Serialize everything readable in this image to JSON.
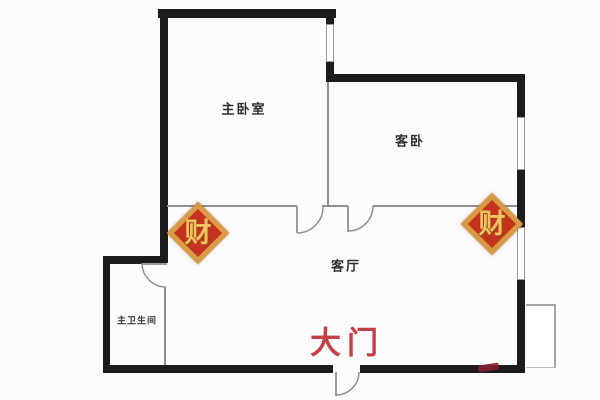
{
  "page": {
    "type": "apartment-floor-plan"
  },
  "rooms": {
    "master_bedroom": "主卧室",
    "guest_bedroom": "客卧",
    "living_room": "客厅",
    "master_bathroom": "主卫生间"
  },
  "entrance": {
    "label": "大门",
    "color": "#c24048"
  },
  "charm": {
    "glyph": "财",
    "fill": "#c5321e",
    "border": "#d89b44",
    "glyph_color": "#f5c163"
  },
  "colors": {
    "wall": "#1c1c1c",
    "thin_wall": "#8f8f8f",
    "window_border": "#9a9a9a",
    "background": "#fcfcfc"
  }
}
